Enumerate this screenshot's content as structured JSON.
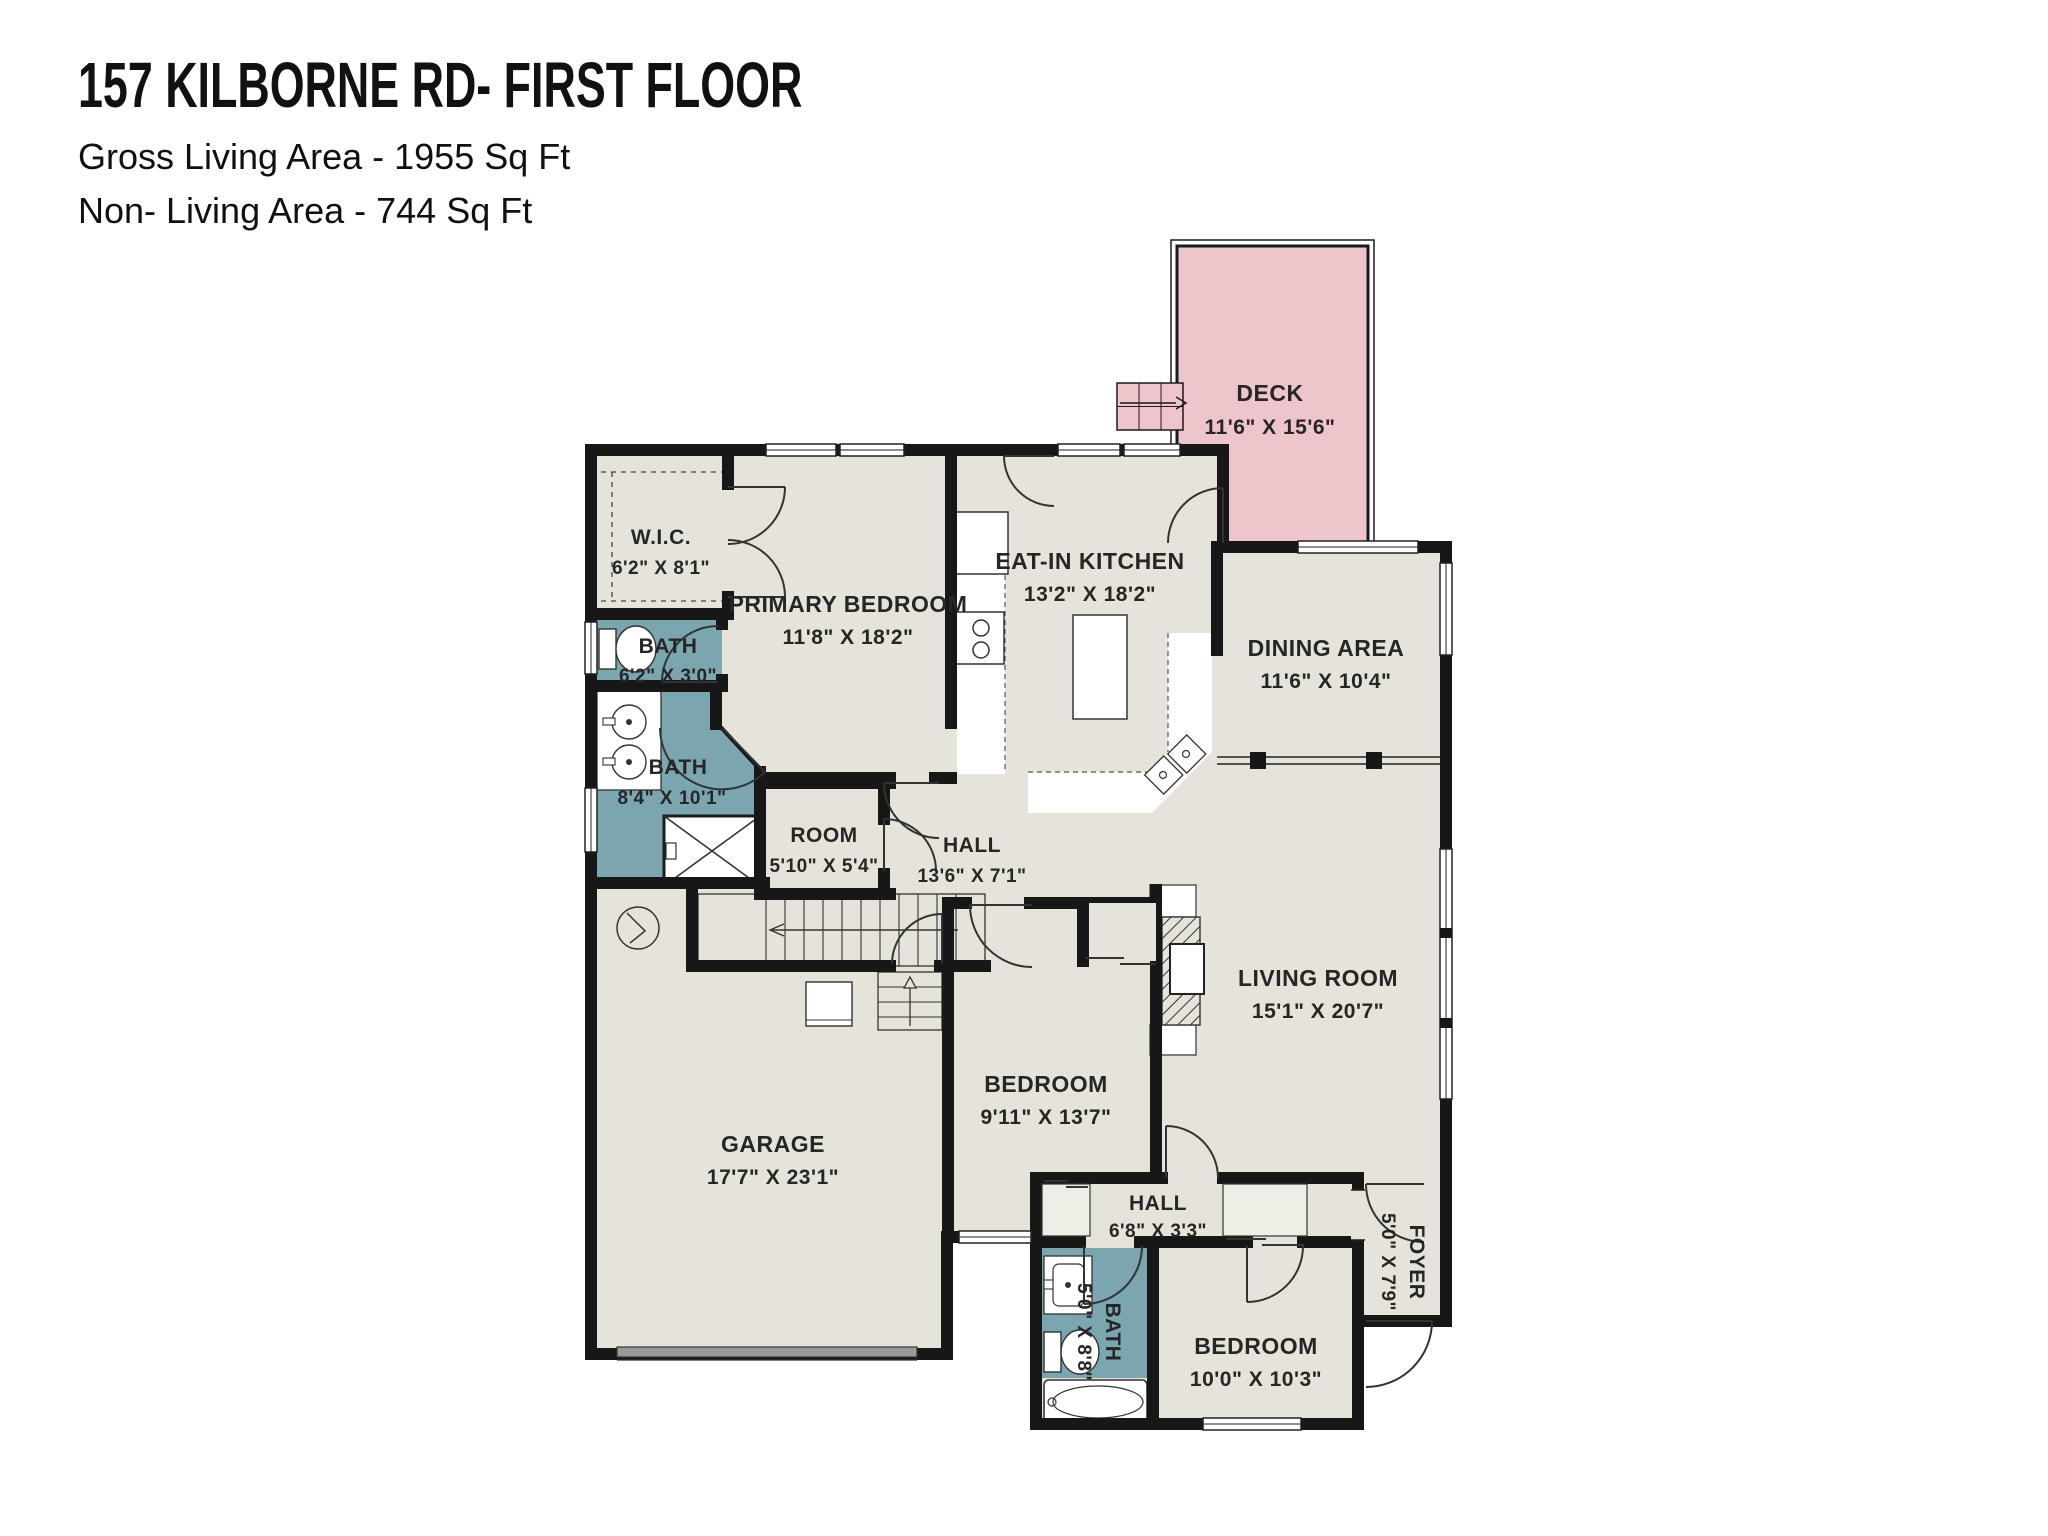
{
  "header": {
    "title": "157 KILBORNE RD- FIRST FLOOR",
    "line1": "Gross Living Area - 1955 Sq Ft",
    "line2": "Non- Living Area - 744 Sq Ft"
  },
  "colors": {
    "room_fill": "#e6e4da",
    "wet_room_fill": "#7ba6b0",
    "deck_fill": "#edc5ca",
    "wall": "#171717",
    "garage_door": "#9a9a9a",
    "label_text": "#262626"
  },
  "rooms": {
    "deck": {
      "name": "DECK",
      "dims": "11'6\" X 15'6\""
    },
    "wic": {
      "name": "W.I.C.",
      "dims": "6'2\" X 8'1\""
    },
    "primary_bedroom": {
      "name": "PRIMARY BEDROOM",
      "dims": "11'8\" X 18'2\""
    },
    "eat_in_kitchen": {
      "name": "EAT-IN KITCHEN",
      "dims": "13'2\" X 18'2\""
    },
    "dining_area": {
      "name": "DINING AREA",
      "dims": "11'6\" X 10'4\""
    },
    "bath_small": {
      "name": "BATH",
      "dims": "6'2\" X 3'0\""
    },
    "bath_primary": {
      "name": "BATH",
      "dims": "8'4\" X 10'1\""
    },
    "room": {
      "name": "ROOM",
      "dims": "5'10\" X 5'4\""
    },
    "hall_main": {
      "name": "HALL",
      "dims": "13'6\" X 7'1\""
    },
    "living_room": {
      "name": "LIVING ROOM",
      "dims": "15'1\" X 20'7\""
    },
    "garage": {
      "name": "GARAGE",
      "dims": "17'7\" X 23'1\""
    },
    "bedroom_center": {
      "name": "BEDROOM",
      "dims": "9'11\" X 13'7\""
    },
    "hall_small": {
      "name": "HALL",
      "dims": "6'8\" X 3'3\""
    },
    "bath_hall": {
      "name": "BATH",
      "dims": "5'0\" X 8'8\""
    },
    "bedroom_corner": {
      "name": "BEDROOM",
      "dims": "10'0\" X 10'3\""
    },
    "foyer": {
      "name": "FOYER",
      "dims": "5'0\" X 7'9\""
    }
  }
}
